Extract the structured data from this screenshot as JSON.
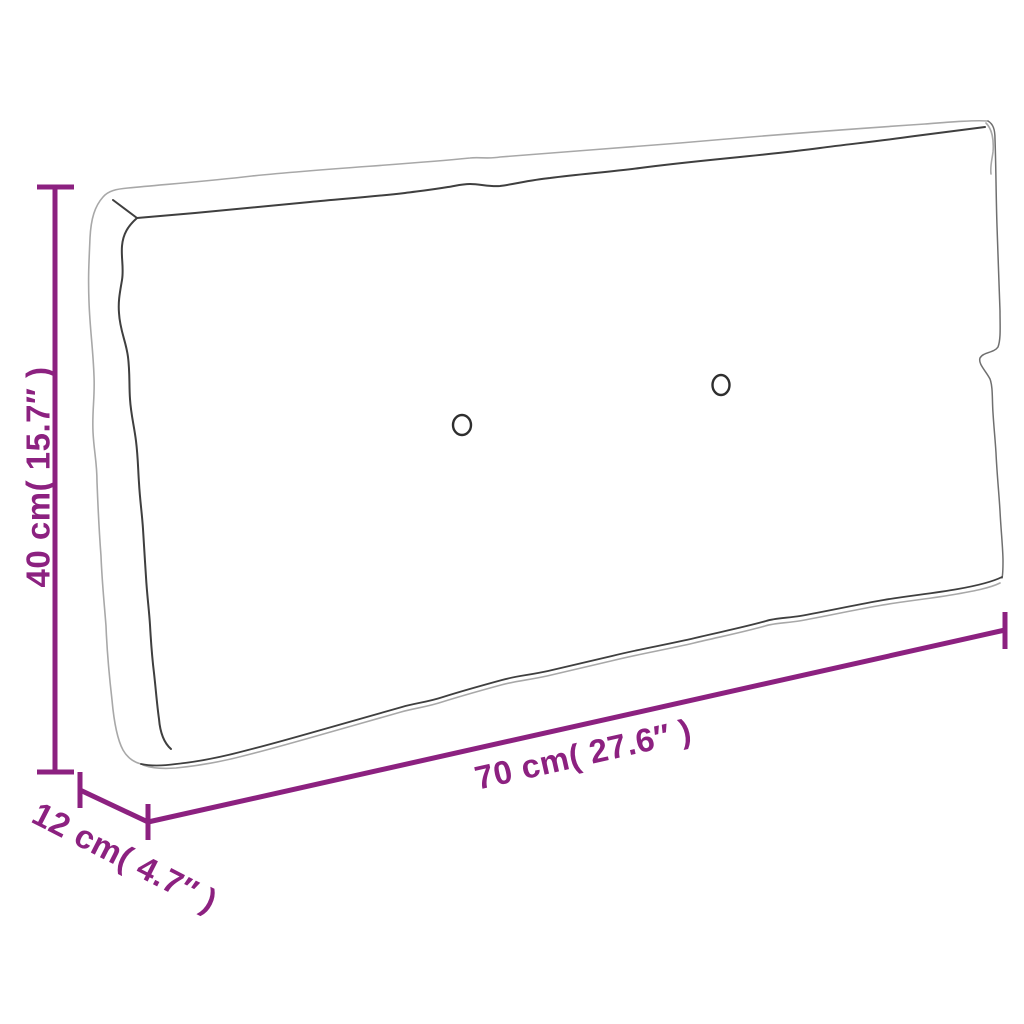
{
  "figure": {
    "title": "Pallet cushion dimension diagram",
    "style": "hand-drawn outline sketch on white background",
    "buttons_on_cushion": 2
  },
  "dimensions": {
    "height": {
      "label": "40 cm( 15.7″ )",
      "value_cm": 40,
      "value_inch": 15.7,
      "orientation": "vertical-left"
    },
    "width": {
      "label": "70 cm( 27.6″ )",
      "value_cm": 70,
      "value_inch": 27.6,
      "orientation": "diagonal-bottom"
    },
    "depth": {
      "label": "12 cm( 4.7″ )",
      "value_cm": 12,
      "value_inch": 4.7,
      "orientation": "diagonal-bottom-left"
    }
  },
  "colors": {
    "dimension_accent": "#8C2180",
    "outline_light": "#a8a8a8",
    "outline_mid": "#6f6f6f",
    "outline_dark": "#3f3f3f",
    "button_stroke": "#2e2e2e",
    "background": "#ffffff"
  }
}
